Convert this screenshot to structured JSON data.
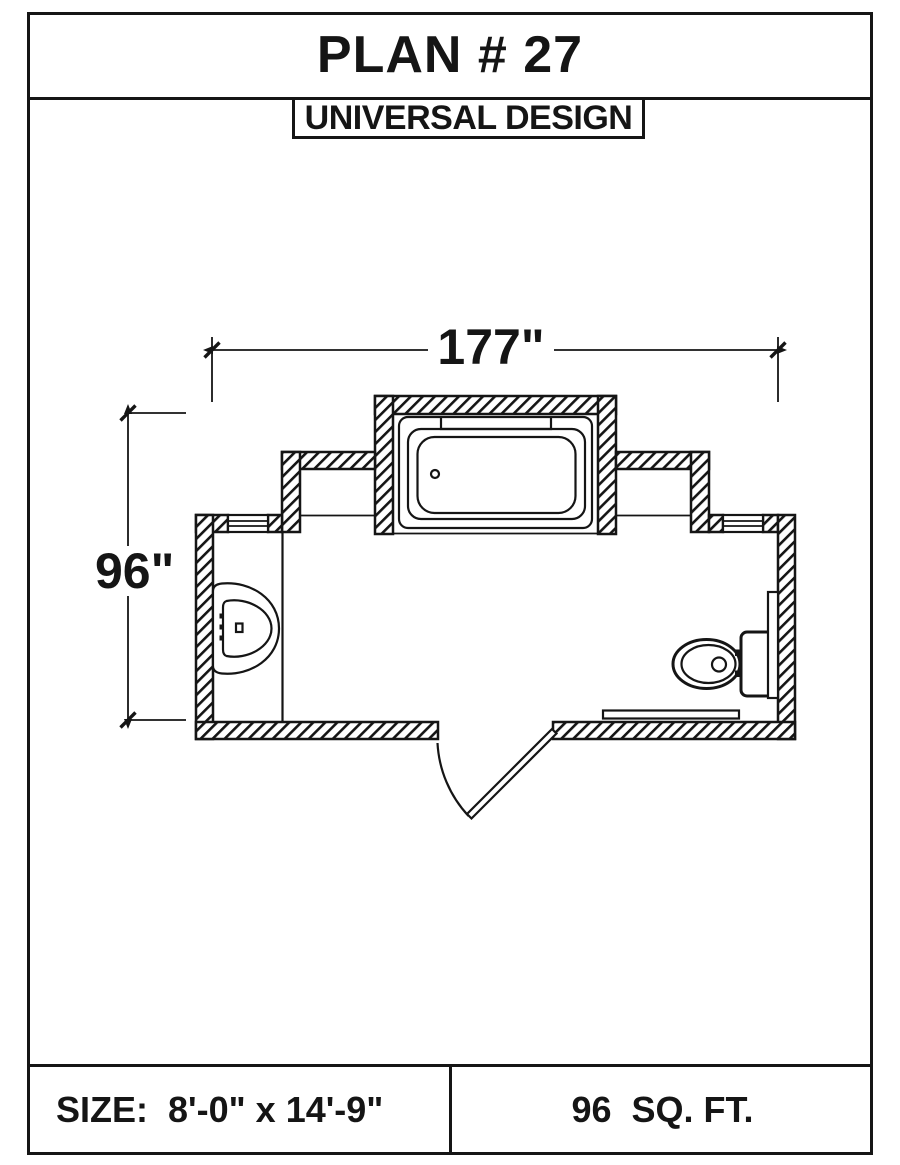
{
  "page": {
    "title": "PLAN # 27",
    "subtitle": "UNIVERSAL DESIGN"
  },
  "dimensions": {
    "width_label": "177\"",
    "depth_label": "96\""
  },
  "footer": {
    "size_label": "SIZE:  8'-0\" x 14'-9\"",
    "area_label": "96  SQ. FT."
  },
  "drawing": {
    "type": "bathroom floor plan",
    "fixtures": [
      "bathtub-in-alcove",
      "wall-hung-sink",
      "toilet-with-tank",
      "entry-door-swing",
      "grab-bar-right-wall",
      "grab-bar-bottom-wall",
      "window-left",
      "window-right",
      "vanity-counter-line"
    ]
  },
  "colors": {
    "ink": "#151515",
    "background": "#ffffff"
  }
}
